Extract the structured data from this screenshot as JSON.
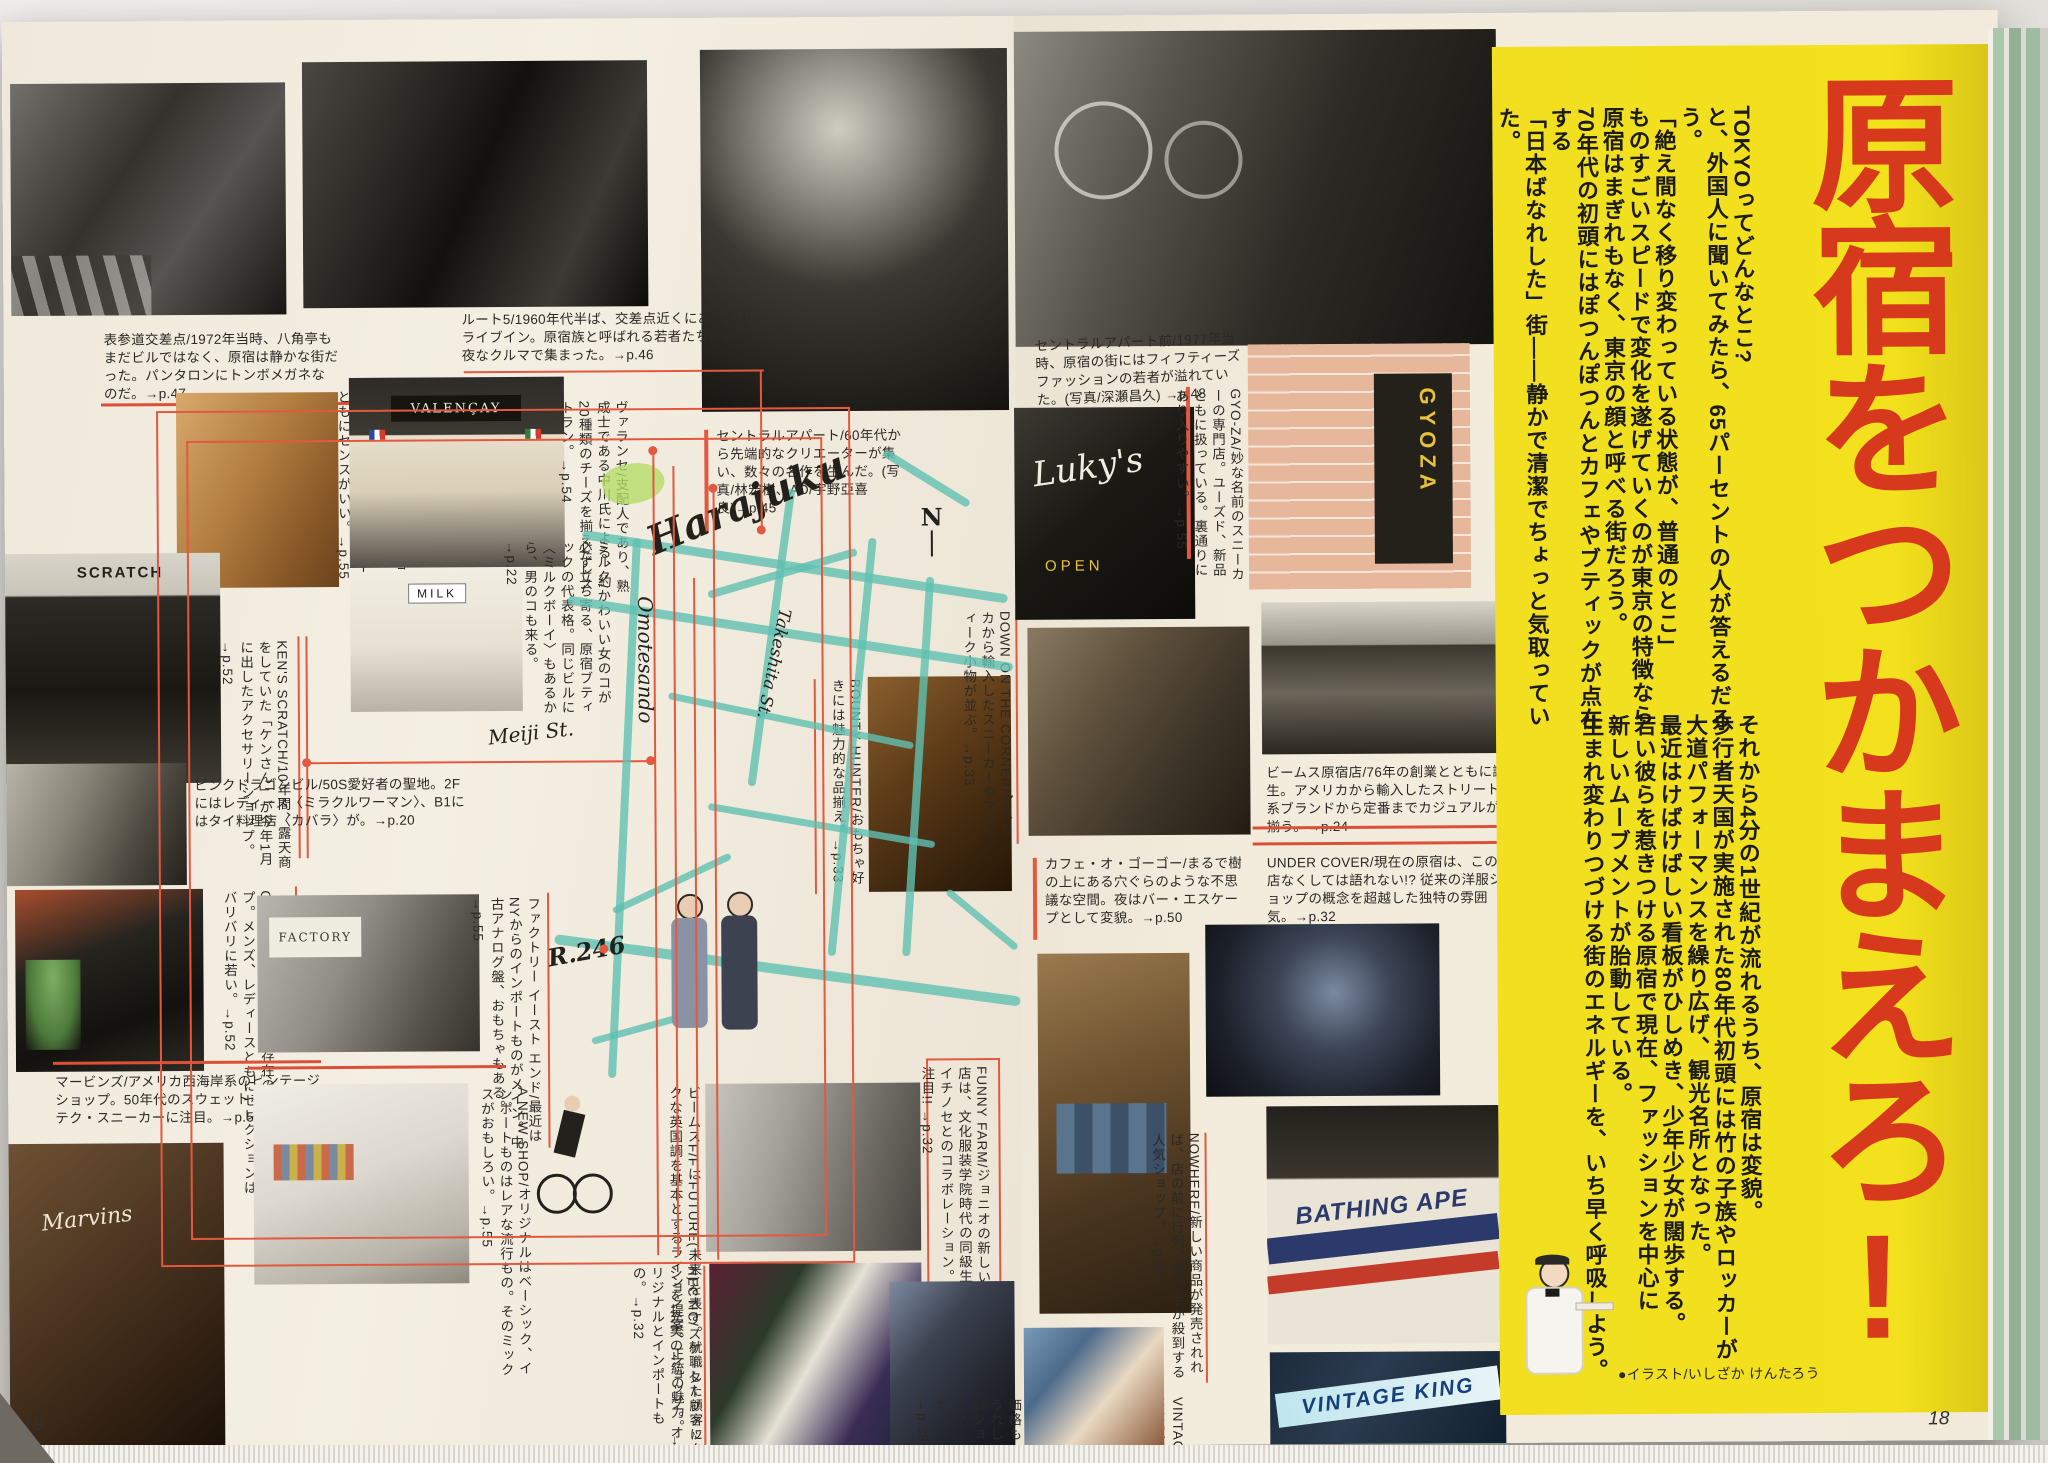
{
  "page": {
    "left_number": "19",
    "right_number": "18",
    "credit": "●イラスト/いしざか けんたろう"
  },
  "feature": {
    "title": "原宿をつかまえろ!",
    "accent_color": "#d6391b",
    "panel_color": "#f2e11c",
    "intro_block1": [
      "TOKYOってどんなとこ?",
      "と、外国人に聞いてみたら、65パーセントの人が答えるだろう。",
      "「絶え間なく移り変わっている状態が、普通のとこ」",
      "ものすごいスピードで変化を遂げていくのが東京の特徴なら",
      "原宿はまぎれもなく、東京の顔と呼べる街だろう。",
      "70年代の初頭にはぽつんぽつんとカフェやブティックが点在する",
      "「日本ばなれした」街――静かで清潔でちょっと気取っていた。"
    ],
    "intro_block2": [
      "それから4分の1世紀が流れるうち、原宿は変貌。",
      "歩行者天国が実施された80年代初頭には竹の子族やロッカーが",
      "大道パフォーマンスを繰り広げ、観光名所となった。",
      "最近はけばけばしい看板がひしめき、少年少女が闊歩する。",
      "若い彼らを惹きつける原宿で現在、ファッションを中心に",
      "新しいムーブメントが胎動している。",
      "生まれ変わりつづける街のエネルギーを、いち早く呼吸しよう。"
    ]
  },
  "map": {
    "harajuku": "Harajuku",
    "omotesando": "Omotesando",
    "takeshita": "Takeshita St.",
    "meiji": "Meiji St.",
    "route246": "R.246",
    "north": "N"
  },
  "photo_labels": {
    "valencay": "VALENÇAY",
    "milk": "MILK",
    "factory": "FACTORY",
    "kens": "SCRATCH",
    "lukys": "Luky's",
    "lukys_open": "OPEN",
    "gyoza_window": "GYOZA",
    "bathing_ape": "BATHING APE",
    "vintage_king": "VINTAGE KING",
    "marvins": "Marvins"
  },
  "captions": {
    "omotesando_crossing": "表参道交差点/1972年当時、八角亭もまだビルではなく、原宿は静かな街だった。パンタロンにトンボメガネなのだ。→p.47",
    "route5": "ルート5/1960年代半ば、交差点近くにあったドライブイン。原宿族と呼ばれる若者たちが夜な夜なクルマで集まった。→p.46",
    "central_apart": "セントラルアパート/60年代から先端的なクリエーターが集い、数々の名作を生んだ。(写真/林宏樹、AD/宇野亞喜良)→p.45",
    "central_apart_mae": "セントラルアパート前/1977年当時、原宿の街にはフィフティーズファッションの若者が溢れていた。(写真/深瀬昌久) →p.48",
    "colors_vintage": "カラーズ ヴィンテージ ショップXX/赤ミミなどもあるが、新品の品揃えが国内、インポートともにセンスがいい。→p.55",
    "valencay": "ヴァランセ/支配人であり、熟成士である中川氏による、約20種類のチーズを揃えたレストラン。→p.54",
    "milk": "ミルク/かわいい女のコが必ず立ち寄る、原宿ブティックの代表格。同じビルに〈ミルクボーイ〉もあるから、男のコも来る。→p.22",
    "kens_scratch": "KEN'S SCRATCH/10年間、露天商をしていた「ケンさん」が今年1月に出したアクセサリーショップ。→p.52",
    "pink_dragon": "ピンクドラゴンビル/50S愛好者の聖地。2Fにはレディース〈ミラクルワーマン〉、B1にはタイ料理店〈カバラ〉が。→p.20",
    "one_day": "ONE DAY/流行発信地的存在のセレクトショップ。メンズ、レディースともにセレクションはバリバリに若い。→p.52",
    "marvins": "マービンズ/アメリカ西海岸系のビンテージショップ。50年代のスウェットものとハイテク・スニーカーに注目。→p.51",
    "factory": "ファクトリー イースト エンド/最近はNYからのインポートものがメイン。中古アナログ盤、おもちゃもある。→p.55",
    "a_new_shop": "A NEW SHOP/オリジナルはベーシック、インポートものはレアな流行もの。そのミックスがおもしろい。→p.55",
    "beams_f": "ビームスF/FはFUTURE(未来)を表す。就職した顧客にクラシックな英国調を基本とするラインを提案。正統の魅力。→p.24",
    "hectic": "HECTIC/スケーターファッション充実のショップ。オリジナルとインポートもの。→p.32",
    "funny_farm": "FUNNY FARM/ジョニオの新しい店は、文化服装学院時代の同級生イチノセとのコラボレーション。注目!! →p.32",
    "down_on_the_corner": "DOWN ON THE CORNER/アメリカから輸入したスニーカーやアンティーク小物が並ぶ。→p.33",
    "bounty_hunter": "BOUNTY HUNTER/おもちゃ好きには魅力的な品揃え。→p.33",
    "gyoza": "GYO-ZA/妙な名前のスニーカーの専門店。ユーズド、新品ともに扱っている。裏通りにあり入りやすい。→p.55",
    "beams_harajuku": "ビームス原宿店/76年の創業とともに誕生。アメリカから輸入したストリート系ブランドから定番までカジュアルが揃う。→p.24",
    "under_cover": "UNDER COVER/現在の原宿は、この店なくしては語れない!? 従来の洋服ショップの概念を超越した独特の雰囲気。→p.32",
    "cafe_o_gogo": "カフェ・オ・ゴーゴー/まるで樹の上にある穴ぐらのような不思議な空間。夜はバー・エスケープとして変貌。→p.50",
    "nowhere": "NOWHERE/新しい商品が発売されれば、店の前に行列。買い手が殺到する人気ショップ。→p.32",
    "vintage_king": "VINTAGE KING/広い店内には、古着が豊富。リーズナブルな価格もうれしいショップだ。→p.33"
  }
}
